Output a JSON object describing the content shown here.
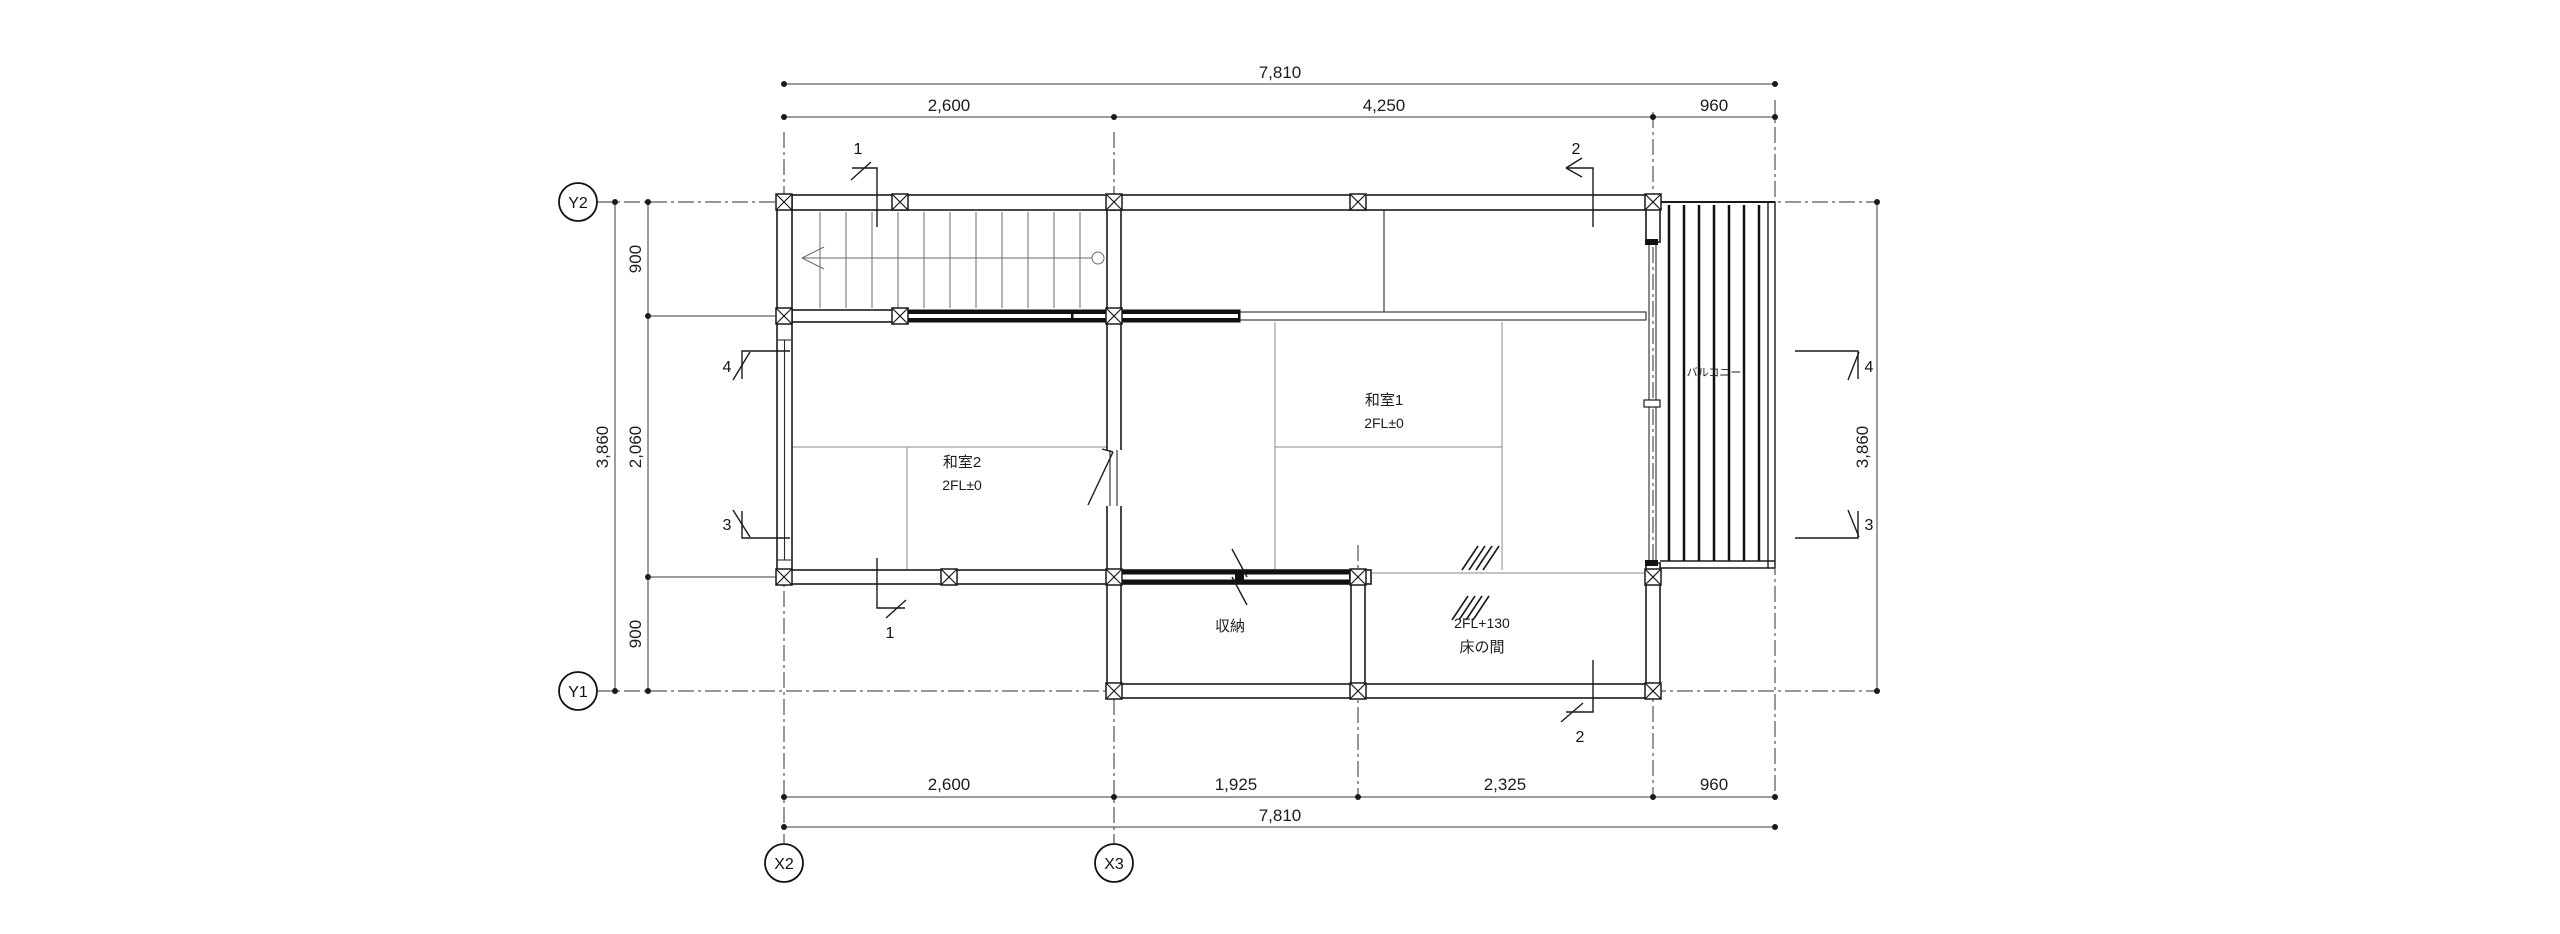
{
  "plan": {
    "rooms": {
      "washitsu1": {
        "name": "和室1",
        "level": "2FL±0"
      },
      "washitsu2": {
        "name": "和室2",
        "level": "2FL±0"
      },
      "shuno": {
        "name": "収納"
      },
      "tokonoma": {
        "name": "床の間",
        "level": "2FL+130"
      },
      "balcony": {
        "name": "バルコニー"
      }
    },
    "grid_labels": {
      "y2": "Y2",
      "y1": "Y1",
      "x2": "X2",
      "x3": "X3"
    },
    "dims": {
      "top_overall": "7,810",
      "top_seg1": "2,600",
      "top_seg2": "4,250",
      "top_seg3": "960",
      "bottom_seg1": "2,600",
      "bottom_seg2": "1,925",
      "bottom_seg3": "2,325",
      "bottom_seg4": "960",
      "bottom_overall": "7,810",
      "left_overall": "3,860",
      "left_seg_top": "900",
      "left_seg_mid": "2,060",
      "left_seg_bot": "900",
      "right_overall": "3,860"
    },
    "sections": {
      "s1": "1",
      "s2": "2",
      "s3": "3",
      "s4": "4"
    },
    "colors": {
      "line": "#1a1a1a",
      "background": "#ffffff"
    }
  }
}
